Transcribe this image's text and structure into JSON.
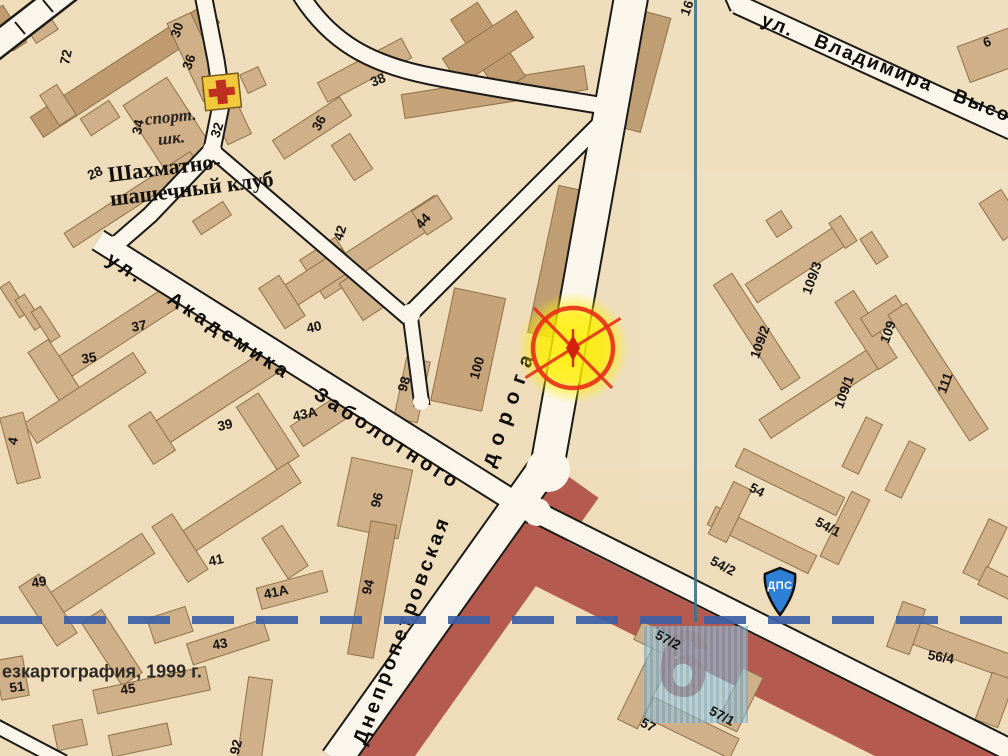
{
  "map": {
    "copyright": "езкартография, 1999 г.",
    "sheet_number_large": "6",
    "badge_text": "ДПС",
    "colors": {
      "paper_beige": "#eedcba",
      "building_tan": "#cfb089",
      "zone_red": "#b45a4e",
      "marker_yellow": "#ffee00",
      "marker_red": "#e93117",
      "badge_blue": "#2e80d6",
      "grid_dash_blue": "#3c5fa6",
      "grid_line_teal": "#3e7387",
      "cross_red": "#c03020",
      "cross_yellow": "#f2c83d"
    },
    "street_labels": [
      {
        "t": "ул. Академика Заболотного",
        "x": 108,
        "y": 258,
        "r": 33,
        "s": 20,
        "ls": 4,
        "ws": 22
      },
      {
        "t": "Днепропетровская",
        "x": 360,
        "y": 744,
        "r": -69.5,
        "s": 20,
        "ls": 3.5,
        "ws": 2
      },
      {
        "t": "дорога",
        "x": 488,
        "y": 466,
        "r": -70,
        "s": 21,
        "ls": 9,
        "ws": 2
      },
      {
        "t": "ул. Владимира Высоц",
        "x": 762,
        "y": 20,
        "r": 21.5,
        "s": 19,
        "ls": 2,
        "ws": 16
      }
    ],
    "poi_labels": [
      {
        "t": "спорт.",
        "x": 145,
        "y": 120,
        "r": -6,
        "s": 17,
        "f": "serif-italic"
      },
      {
        "t": "шк.",
        "x": 158,
        "y": 140,
        "r": -6,
        "s": 17,
        "f": "serif-italic"
      },
      {
        "t": "Шахматно-",
        "x": 108,
        "y": 175,
        "r": -7,
        "s": 22,
        "f": "serif-bold"
      },
      {
        "t": "шашечный клуб",
        "x": 110,
        "y": 199,
        "r": -7,
        "s": 22,
        "f": "serif-bold"
      },
      {
        "t": "езкартография, 1999 г.",
        "x": 2,
        "y": 672,
        "r": 0,
        "s": 18,
        "f": "sans"
      }
    ],
    "numbers": [
      {
        "t": "72",
        "x": 66,
        "y": 57,
        "r": -78
      },
      {
        "t": "30",
        "x": 177,
        "y": 30,
        "r": -72
      },
      {
        "t": "36",
        "x": 189,
        "y": 62,
        "r": -70
      },
      {
        "t": "34",
        "x": 138,
        "y": 127,
        "r": -78
      },
      {
        "t": "32",
        "x": 217,
        "y": 130,
        "r": -72
      },
      {
        "t": "28",
        "x": 95,
        "y": 173,
        "r": -25
      },
      {
        "t": "36",
        "x": 319,
        "y": 123,
        "r": -62
      },
      {
        "t": "38",
        "x": 378,
        "y": 80,
        "r": -22
      },
      {
        "t": "42",
        "x": 340,
        "y": 233,
        "r": -72
      },
      {
        "t": "44",
        "x": 423,
        "y": 221,
        "r": -48
      },
      {
        "t": "40",
        "x": 314,
        "y": 327,
        "r": -12
      },
      {
        "t": "37",
        "x": 139,
        "y": 326,
        "r": -10
      },
      {
        "t": "35",
        "x": 89,
        "y": 358,
        "r": -10
      },
      {
        "t": "4",
        "x": 13,
        "y": 441,
        "r": -78
      },
      {
        "t": "39",
        "x": 225,
        "y": 425,
        "r": -12
      },
      {
        "t": "43A",
        "x": 305,
        "y": 414,
        "r": -12
      },
      {
        "t": "98",
        "x": 404,
        "y": 384,
        "r": -74
      },
      {
        "t": "100",
        "x": 477,
        "y": 368,
        "r": -74
      },
      {
        "t": "96",
        "x": 377,
        "y": 500,
        "r": -76
      },
      {
        "t": "94",
        "x": 368,
        "y": 587,
        "r": -76
      },
      {
        "t": "92",
        "x": 236,
        "y": 747,
        "r": -76
      },
      {
        "t": "49",
        "x": 39,
        "y": 582,
        "r": -10
      },
      {
        "t": "41",
        "x": 216,
        "y": 560,
        "r": -12
      },
      {
        "t": "41A",
        "x": 276,
        "y": 592,
        "r": -12
      },
      {
        "t": "43",
        "x": 220,
        "y": 644,
        "r": -10
      },
      {
        "t": "45",
        "x": 128,
        "y": 689,
        "r": -8
      },
      {
        "t": "51",
        "x": 17,
        "y": 687,
        "r": -8
      },
      {
        "t": "109/3",
        "x": 812,
        "y": 278,
        "r": -70
      },
      {
        "t": "109/2",
        "x": 760,
        "y": 342,
        "r": -70
      },
      {
        "t": "109/1",
        "x": 844,
        "y": 392,
        "r": -70
      },
      {
        "t": "109",
        "x": 888,
        "y": 332,
        "r": -70
      },
      {
        "t": "111",
        "x": 945,
        "y": 383,
        "r": -70
      },
      {
        "t": "54",
        "x": 757,
        "y": 490,
        "r": 28
      },
      {
        "t": "54/1",
        "x": 828,
        "y": 527,
        "r": 28
      },
      {
        "t": "54/2",
        "x": 723,
        "y": 566,
        "r": 28
      },
      {
        "t": "56/4",
        "x": 941,
        "y": 657,
        "r": 10
      },
      {
        "t": "57/2",
        "x": 668,
        "y": 640,
        "r": 28
      },
      {
        "t": "57/1",
        "x": 722,
        "y": 716,
        "r": 28
      },
      {
        "t": "57",
        "x": 648,
        "y": 725,
        "r": 28
      },
      {
        "t": "6",
        "x": 987,
        "y": 42,
        "r": -18
      },
      {
        "t": "16",
        "x": 687,
        "y": 8,
        "r": -70
      }
    ]
  }
}
